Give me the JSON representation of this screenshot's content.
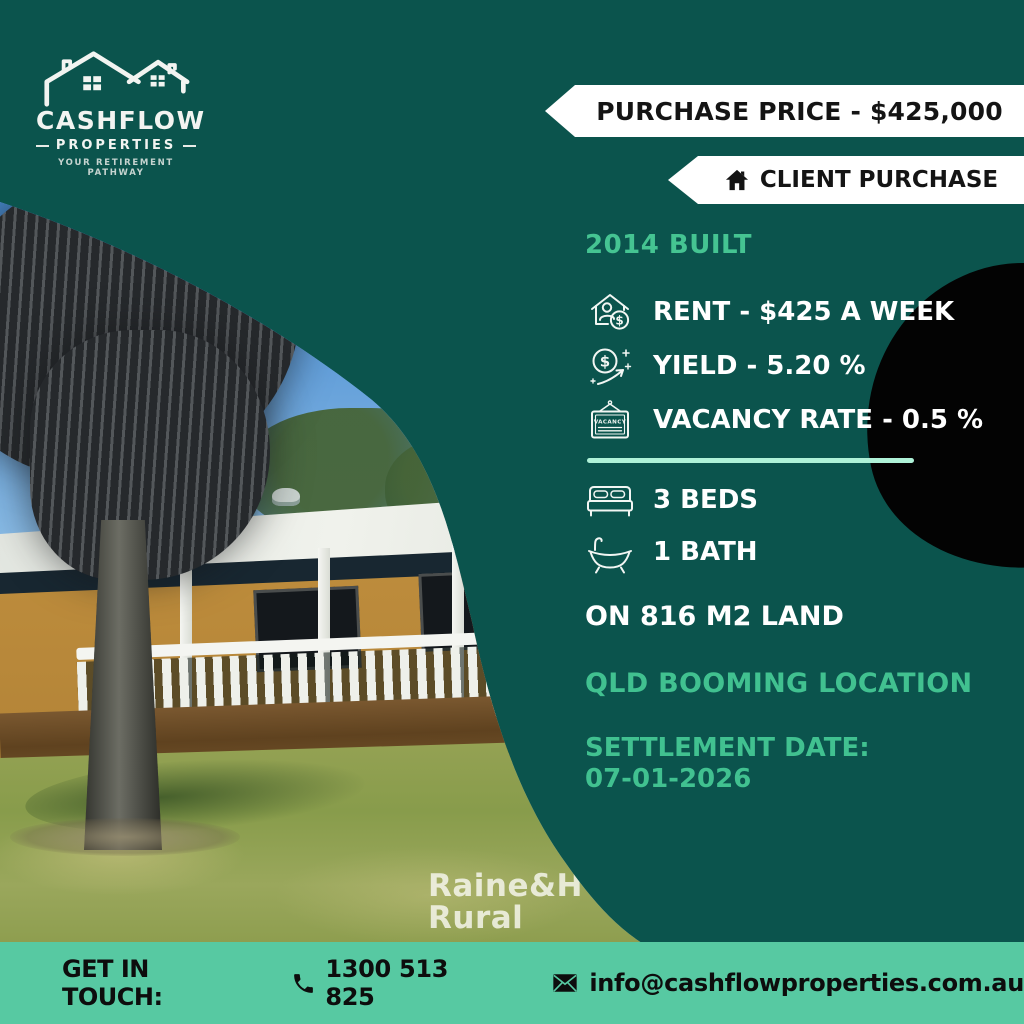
{
  "colors": {
    "background_teal": "#0b544d",
    "footer_mint": "#57c9a2",
    "accent_mint_text": "#41c190",
    "divider_mint": "#aff2d8",
    "ribbon_bg": "#ffffff",
    "ribbon_text": "#141414",
    "black_blob": "#030303"
  },
  "logo": {
    "brand": "CASHFLOW",
    "sub": "PROPERTIES",
    "tagline": "YOUR RETIREMENT PATHWAY",
    "icon": "twin-houses-logo-icon"
  },
  "ribbons": {
    "purchase_price": "PURCHASE PRICE - $425,000",
    "client_purchase": "CLIENT PURCHASE",
    "client_icon": "home-icon"
  },
  "details": {
    "built": "2014 BUILT",
    "stats": [
      {
        "icon": "rent-house-dollar-icon",
        "label": "RENT - $425 A WEEK"
      },
      {
        "icon": "yield-dollar-growth-icon",
        "label": "YIELD - 5.20 %"
      },
      {
        "icon": "vacancy-sign-icon",
        "label": "VACANCY RATE - 0.5 %"
      }
    ],
    "vacancy_icon_text": "VACANCY",
    "features": [
      {
        "icon": "bed-icon",
        "label": "3 BEDS"
      },
      {
        "icon": "bathtub-icon",
        "label": "1 BATH"
      }
    ],
    "land": "ON 816 M2 LAND",
    "location": "QLD BOOMING LOCATION",
    "settlement_label": "SETTLEMENT DATE:",
    "settlement_date": "07-01-2026"
  },
  "photo": {
    "description": "brick house with white veranda railing, palm tree and lawn",
    "watermark_line1": "Raine&H",
    "watermark_line2": "Rural"
  },
  "footer": {
    "get_in_touch": "GET IN TOUCH:",
    "phone_icon": "phone-icon",
    "phone": "1300 513 825",
    "email_icon": "envelope-icon",
    "email": "info@cashflowproperties.com.au"
  }
}
